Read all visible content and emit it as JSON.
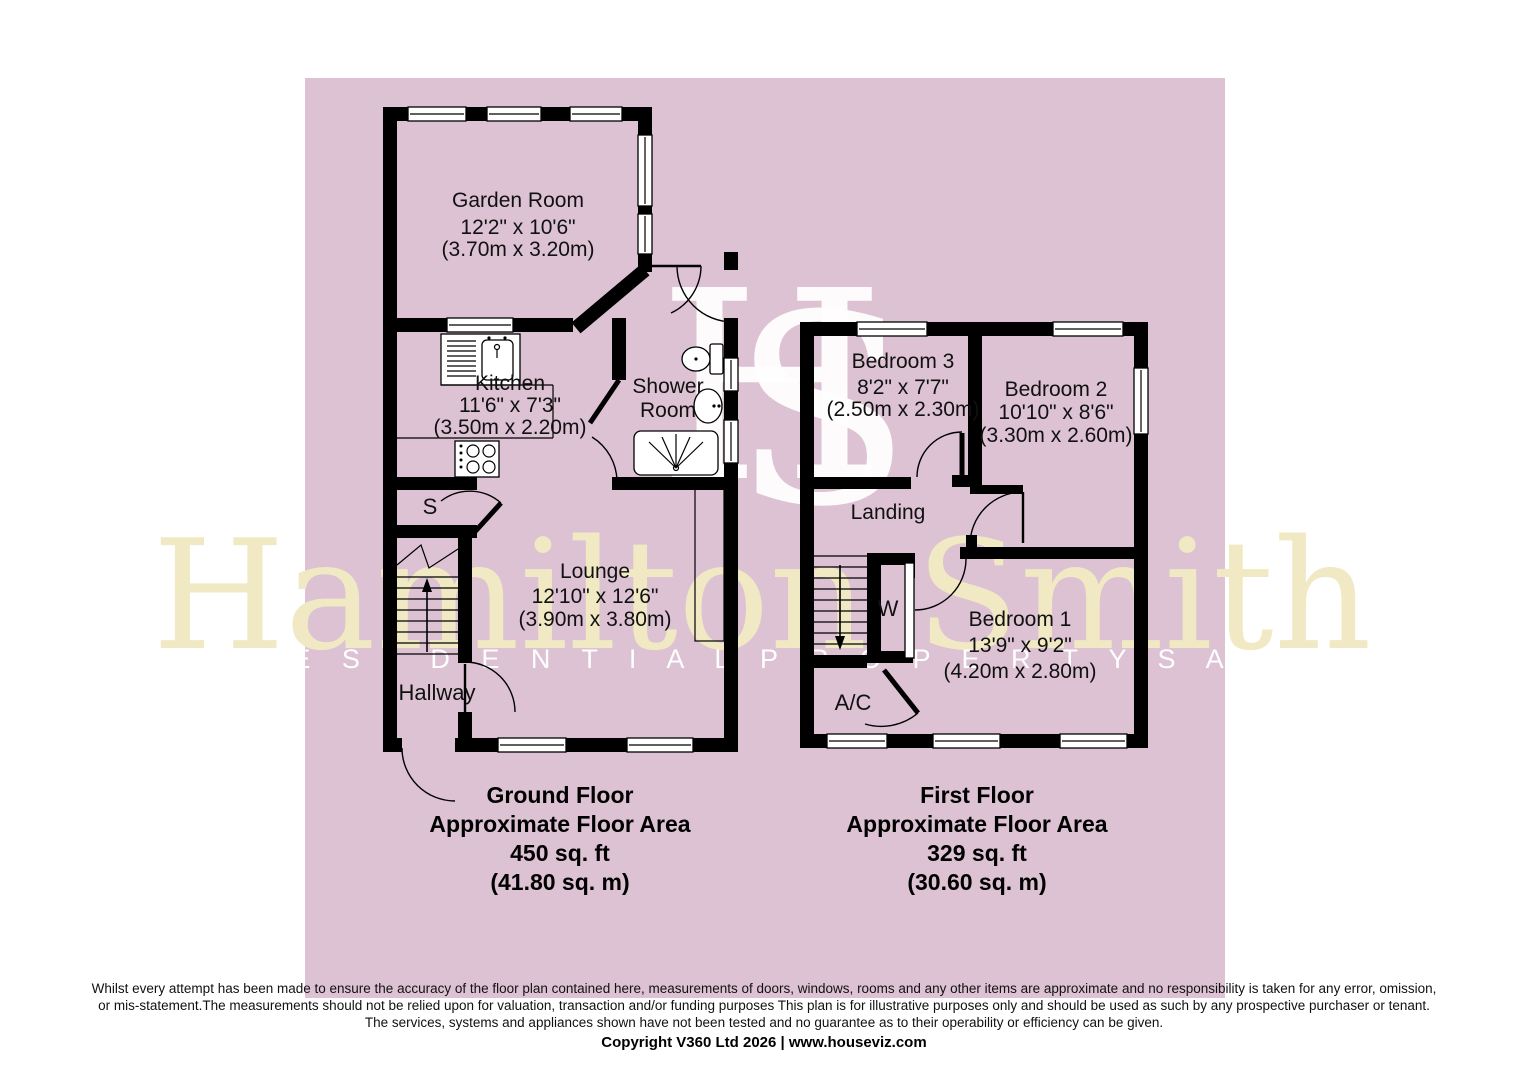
{
  "watermark": {
    "monogram_letters": [
      "H",
      "S"
    ],
    "name": "Hamilton Smith",
    "tagline": "R E S I D E N T I A L   P R O P E R T Y   S A L E S"
  },
  "ground_floor": {
    "title": "Ground Floor",
    "area_label": "Approximate Floor Area",
    "area_imperial": "450 sq. ft",
    "area_metric": "(41.80 sq. m)",
    "rooms": [
      {
        "name": "Garden Room",
        "imperial": "12'2\" x 10'6\"",
        "metric": "(3.70m x 3.20m)"
      },
      {
        "name": "Kitchen",
        "imperial": "11'6\" x 7'3\"",
        "metric": "(3.50m x 2.20m)"
      },
      {
        "name": "Shower Room",
        "name_lines": [
          "Shower",
          "Room"
        ]
      },
      {
        "name": "Lounge",
        "imperial": "12'10\" x 12'6\"",
        "metric": "(3.90m x 3.80m)"
      },
      {
        "name": "Hallway"
      },
      {
        "name": "S"
      }
    ]
  },
  "first_floor": {
    "title": "First Floor",
    "area_label": "Approximate Floor Area",
    "area_imperial": "329 sq. ft",
    "area_metric": "(30.60 sq. m)",
    "rooms": [
      {
        "name": "Bedroom 3",
        "imperial": "8'2\" x 7'7\"",
        "metric": "(2.50m x 2.30m)"
      },
      {
        "name": "Bedroom 2",
        "imperial": "10'10\" x 8'6\"",
        "metric": "(3.30m x 2.60m)"
      },
      {
        "name": "Landing"
      },
      {
        "name": "Bedroom 1",
        "imperial": "13'9\" x 9'2\"",
        "metric": "(4.20m x 2.80m)"
      },
      {
        "name": "W"
      },
      {
        "name": "A/C"
      }
    ]
  },
  "footer": {
    "disclaimer_line1": "Whilst every attempt has been made to ensure the accuracy of the floor plan contained here, measurements of doors, windows, rooms and any other items are approximate and no responsibility is taken for any error, omission,",
    "disclaimer_line2": "or mis-statement.The measurements should not be relied upon for valuation, transaction and/or funding purposes This plan is for illustrative purposes only and should be used as such by any prospective purchaser or tenant.",
    "disclaimer_line3": "The services, systems and appliances shown have not been tested and no guarantee as to their operability or efficiency can be given.",
    "copyright": "Copyright V360 Ltd 2026 | www.houseviz.com"
  },
  "colors": {
    "background_pink": "#dcc2d3",
    "wall_black": "#000000",
    "watermark_cream": "#f0e9c3",
    "watermark_white": "#ffffff"
  }
}
